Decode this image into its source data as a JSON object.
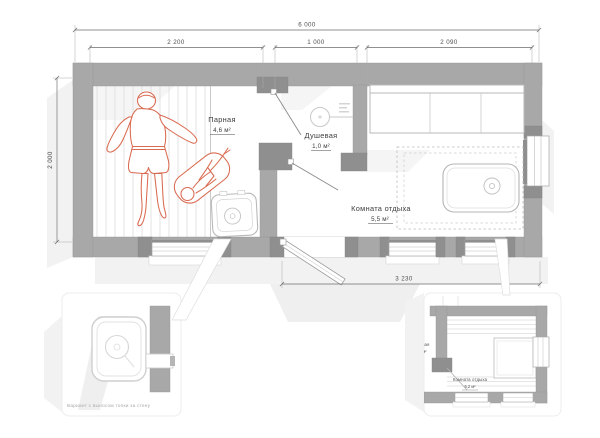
{
  "plan": {
    "dim_total": "6 000",
    "dim_seg1": "2 200",
    "dim_seg2": "1 000",
    "dim_seg3": "2 090",
    "dim_height": "2 000",
    "dim_bottom": "3 230",
    "rooms": {
      "steam": {
        "name": "Парная",
        "area": "4,6 м²"
      },
      "shower": {
        "name": "Душевая",
        "area": "1,0 м²"
      },
      "rest": {
        "name": "Комната отдыха",
        "area": "5,5 м²"
      }
    }
  },
  "callout_left": {
    "caption": "Вариант с выносом топки за стену"
  },
  "callout_right": {
    "room": "Комната отдыха",
    "area": "5,2 м²",
    "clipped_room": "Душевая",
    "clipped_area": "1,0 м²"
  },
  "colors": {
    "figure_red": "#d96a50",
    "wall_gray": "#a8a8a8",
    "wall_dark": "#8f8f8f",
    "paper": "#ffffff"
  }
}
